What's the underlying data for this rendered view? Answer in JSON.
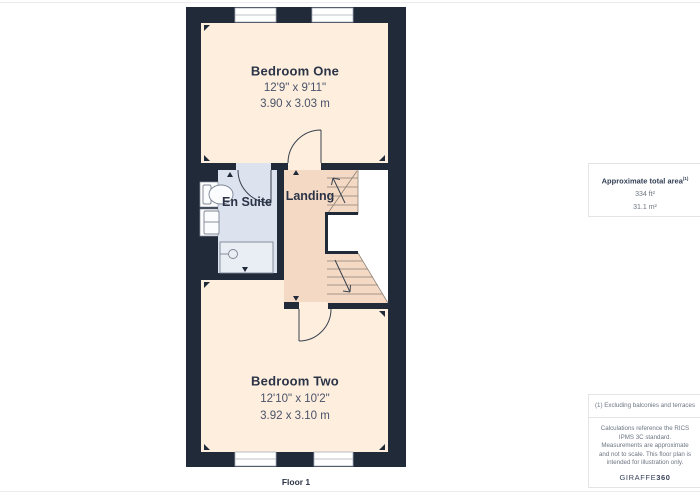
{
  "plan": {
    "floor_label": "Floor 1",
    "rooms": {
      "bedroom_one": {
        "name": "Bedroom One",
        "imperial": "12'9\" x 9'11\"",
        "metric": "3.90 x 3.03 m"
      },
      "bedroom_two": {
        "name": "Bedroom Two",
        "imperial": "12'10\" x 10'2\"",
        "metric": "3.92 x 3.10 m"
      },
      "en_suite": {
        "name": "En Suite"
      },
      "landing": {
        "name": "Landing"
      }
    },
    "colors": {
      "wall": "#202a39",
      "bedroom_floor": "#fdeede",
      "landing_floor": "#f4d9c5",
      "ensuite_floor": "#dde3ee",
      "fixture_stroke": "#7d8494",
      "door_stroke": "#39424f"
    }
  },
  "sidebar": {
    "area_box": {
      "title": "Approximate total area",
      "superscript": "(1)",
      "imperial": "334 ft²",
      "metric": "31.1 m²"
    },
    "footnote": "(1) Excluding balconies and terraces",
    "disclaimer": "Calculations reference the RICS IPMS 3C standard. Measurements are approximate and not to scale. This floor plan is intended for illustration only.",
    "brand": {
      "name": "GIRAFFE",
      "suffix": "360"
    }
  }
}
